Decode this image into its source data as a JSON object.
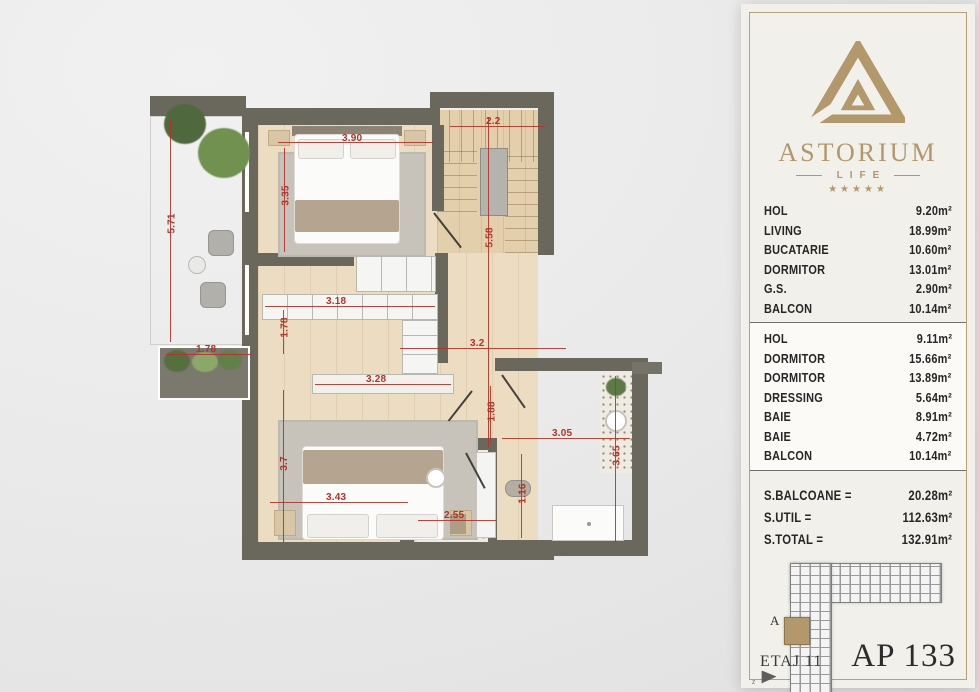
{
  "panel": {
    "brand": {
      "name": "ASTORIUM",
      "sub": "LIFE",
      "stars": "★★★★★"
    },
    "rooms_floor1": [
      {
        "name": "HOL",
        "area": "9.20m²"
      },
      {
        "name": "LIVING",
        "area": "18.99m²"
      },
      {
        "name": "BUCATARIE",
        "area": "10.60m²"
      },
      {
        "name": "DORMITOR",
        "area": "13.01m²"
      },
      {
        "name": "G.S.",
        "area": "2.90m²"
      },
      {
        "name": "BALCON",
        "area": "10.14m²"
      }
    ],
    "rooms_floor2": [
      {
        "name": "HOL",
        "area": "9.11m²"
      },
      {
        "name": "DORMITOR",
        "area": "15.66m²"
      },
      {
        "name": "DORMITOR",
        "area": "13.89m²"
      },
      {
        "name": "DRESSING",
        "area": "5.64m²"
      },
      {
        "name": "BAIE",
        "area": "8.91m²"
      },
      {
        "name": "BAIE",
        "area": "4.72m²"
      },
      {
        "name": "BALCON",
        "area": "10.14m²"
      }
    ],
    "totals": [
      {
        "label": "S.BALCOANE =",
        "value": "20.28m²"
      },
      {
        "label": "S.UTIL =",
        "value": "112.63m²"
      },
      {
        "label": "S.TOTAL =",
        "value": "132.91m²"
      }
    ],
    "keyplan": {
      "label": "A"
    },
    "footer": {
      "floor": "ETAJ 11",
      "apartment": "AP 133"
    }
  },
  "plan": {
    "dims": [
      "5.71",
      "3.90",
      "3.35",
      "2.2",
      "5.58",
      "3.18",
      "1.78",
      "1.78",
      "3.2",
      "3.28",
      "1.88",
      "3.7",
      "3.43",
      "2.55",
      "1.16",
      "3.05",
      "3.65"
    ]
  },
  "colors": {
    "gold": "#b2986a",
    "dim_red": "#b23327",
    "wall": "#6a675d"
  }
}
